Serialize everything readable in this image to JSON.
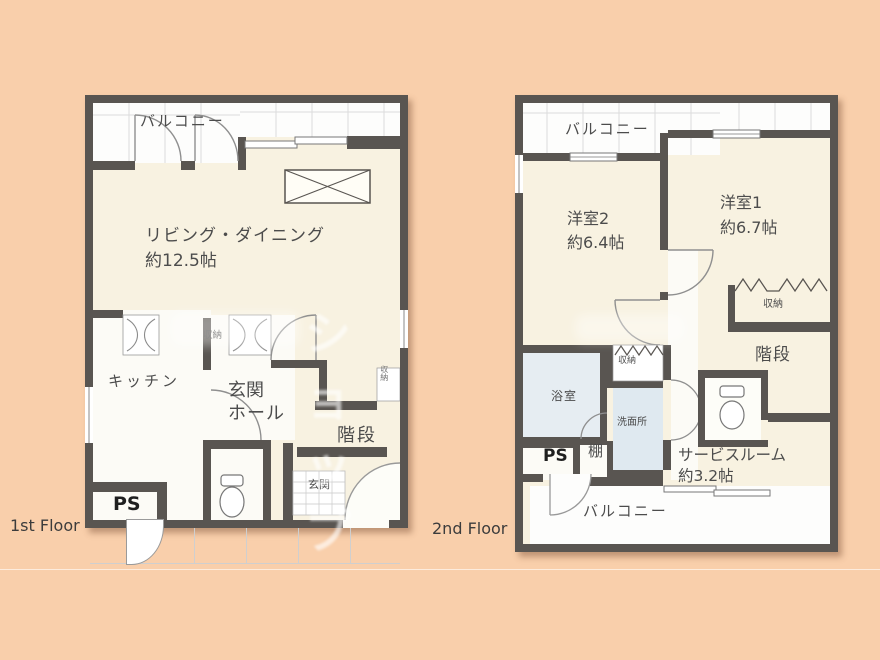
{
  "floor1": {
    "label": "1st Floor",
    "balcony": "バルコニー",
    "living": "リビング・ダイニング",
    "living_size": "約12.5帖",
    "closet": "収納",
    "closet_side": "収納",
    "kitchen": "キッチン",
    "hall_line1": "玄関",
    "hall_line2": "ホール",
    "stairs": "階段",
    "genkan": "玄関",
    "ps": "PS"
  },
  "floor2": {
    "label": "2nd Floor",
    "balcony_top": "バルコニー",
    "room2": "洋室2",
    "room2_size": "約6.4帖",
    "room1": "洋室1",
    "room1_size": "約6.7帖",
    "closet_room1": "収納",
    "closet_mid": "収納",
    "bath": "浴室",
    "washroom": "洗面所",
    "stairs": "階段",
    "service_room": "サービスルーム",
    "service_size": "約3.2帖",
    "ps": "PS",
    "shelf": "棚",
    "balcony_bottom": "バルコニー"
  },
  "watermark": {
    "text": "ショップ"
  },
  "colors": {
    "background": "#f9cfab",
    "wall": "#595551",
    "room_floor": "#f8f2e1",
    "white_floor": "#fcfbf6",
    "balcony": "#fdfdfc",
    "bath": "#e6edf2",
    "washroom": "#dfe9f0"
  }
}
